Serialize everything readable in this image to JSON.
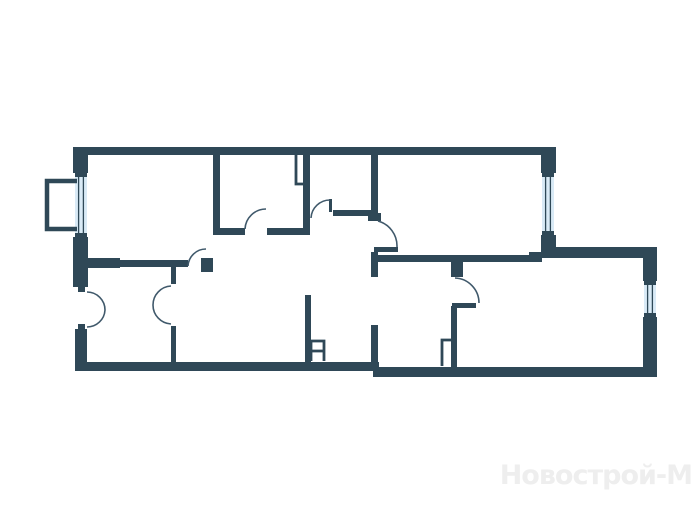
{
  "canvas": {
    "width": 700,
    "height": 525,
    "background": "#ffffff"
  },
  "colors": {
    "wall": "#2f4857",
    "glass": "#d9eaf6",
    "door_arc": "#40596b",
    "watermark": "#eeeeee"
  },
  "watermark": {
    "text": "Новострой-М"
  },
  "floorplan": {
    "rects": [
      {
        "name": "outer-wall-top",
        "x": 73,
        "y": 147,
        "w": 482,
        "h": 8
      },
      {
        "name": "pier-top-left",
        "x": 73,
        "y": 147,
        "w": 15,
        "h": 26
      },
      {
        "name": "pier-left-mid",
        "x": 73,
        "y": 237,
        "w": 15,
        "h": 50
      },
      {
        "name": "door-jamb-notch",
        "x": 78,
        "y": 287,
        "w": 7,
        "h": 5
      },
      {
        "name": "door-jamb-notch",
        "x": 78,
        "y": 324,
        "w": 7,
        "h": 5
      },
      {
        "name": "pier-left-bottom",
        "x": 75,
        "y": 329,
        "w": 12,
        "h": 42
      },
      {
        "name": "outer-wall-bottom-left",
        "x": 75,
        "y": 362,
        "w": 304,
        "h": 9
      },
      {
        "name": "outer-wall-bottom-right",
        "x": 373,
        "y": 367,
        "w": 284,
        "h": 10
      },
      {
        "name": "outer-wall-right-upper",
        "x": 643,
        "y": 247,
        "w": 14,
        "h": 34
      },
      {
        "name": "outer-wall-right-lower",
        "x": 643,
        "y": 317,
        "w": 14,
        "h": 60
      },
      {
        "name": "outer-wall-top-right-sect",
        "x": 555,
        "y": 247,
        "w": 102,
        "h": 11
      },
      {
        "name": "pier-under-tr-window",
        "x": 541,
        "y": 235,
        "w": 15,
        "h": 23
      },
      {
        "name": "wall-step-ledge",
        "x": 529,
        "y": 252,
        "w": 12,
        "h": 6
      },
      {
        "name": "pier-above-tr-window",
        "x": 541,
        "y": 147,
        "w": 15,
        "h": 26
      },
      {
        "name": "wall-room1-right",
        "x": 213,
        "y": 147,
        "w": 7,
        "h": 88
      },
      {
        "name": "wall-kitchen-bottom-left",
        "x": 220,
        "y": 228,
        "w": 25,
        "h": 7
      },
      {
        "name": "wall-kitchen-bottom-right",
        "x": 267,
        "y": 228,
        "w": 41,
        "h": 7
      },
      {
        "name": "wall-shaft-stub",
        "x": 303,
        "y": 155,
        "w": 7,
        "h": 80
      },
      {
        "name": "wall-hall-upper",
        "x": 333,
        "y": 210,
        "w": 40,
        "h": 6
      },
      {
        "name": "door-jamb-tick",
        "x": 329,
        "y": 199,
        "w": 3,
        "h": 13
      },
      {
        "name": "wall-hall-right",
        "x": 371,
        "y": 155,
        "w": 7,
        "h": 60
      },
      {
        "name": "door-jamb",
        "x": 368,
        "y": 213,
        "w": 13,
        "h": 8
      },
      {
        "name": "door-jamb-tick",
        "x": 374,
        "y": 247,
        "w": 24,
        "h": 5
      },
      {
        "name": "wall-hall-stub-lower",
        "x": 371,
        "y": 252,
        "w": 7,
        "h": 25
      },
      {
        "name": "wall-living-bottom",
        "x": 378,
        "y": 255,
        "w": 164,
        "h": 7
      },
      {
        "name": "door-jamb",
        "x": 451,
        "y": 261,
        "w": 12,
        "h": 16
      },
      {
        "name": "door-jamb-tick",
        "x": 452,
        "y": 303,
        "w": 24,
        "h": 5
      },
      {
        "name": "wall-bath-partition",
        "x": 451,
        "y": 306,
        "w": 6,
        "h": 61
      },
      {
        "name": "wall-hall-lower",
        "x": 371,
        "y": 325,
        "w": 7,
        "h": 42
      },
      {
        "name": "wall-corridor-left",
        "x": 305,
        "y": 295,
        "w": 6,
        "h": 67
      },
      {
        "name": "wall-room1-bottom-thick",
        "x": 88,
        "y": 258,
        "w": 32,
        "h": 10
      },
      {
        "name": "wall-room1-bottom",
        "x": 120,
        "y": 260,
        "w": 68,
        "h": 7
      },
      {
        "name": "door-jamb",
        "x": 201,
        "y": 258,
        "w": 12,
        "h": 14
      },
      {
        "name": "wall-room2-divider-top",
        "x": 171,
        "y": 262,
        "w": 5,
        "h": 22
      },
      {
        "name": "wall-room2-divider-bottom",
        "x": 171,
        "y": 326,
        "w": 5,
        "h": 36
      }
    ],
    "windows": [
      {
        "name": "window-left",
        "x": 75,
        "y": 173,
        "w": 12,
        "h": 64
      },
      {
        "name": "window-top-right",
        "x": 542,
        "y": 173,
        "w": 12,
        "h": 62
      },
      {
        "name": "window-bottom-right",
        "x": 644,
        "y": 281,
        "w": 12,
        "h": 36
      }
    ],
    "strokes": [
      {
        "name": "balcony-outline",
        "width": 4.5,
        "d": "M 77 181 H 47 V 229 H 77"
      },
      {
        "name": "vent-shaft-top",
        "width": 2.8,
        "d": "M 296 155 V 184 H 303"
      },
      {
        "name": "vent-shaft-mid",
        "width": 2.8,
        "d": "M 311 361 V 341 H 324 V 361 M 311 351 H 324"
      },
      {
        "name": "vent-shaft-bath",
        "width": 2.8,
        "d": "M 442 366 V 340 H 451"
      }
    ],
    "arcs": [
      {
        "name": "door-swing-balcony-leaf-top",
        "d": "M 87 292 A 18 18 0 0 1 105 310"
      },
      {
        "name": "door-swing-balcony-leaf-bottom",
        "d": "M 87 327 A 18 18 0 0 0 105 310"
      },
      {
        "name": "door-swing-room2-leaf-top",
        "d": "M 171 286 A 19 19 0 0 0 153 305"
      },
      {
        "name": "door-swing-room2-leaf-bottom",
        "d": "M 171 324 A 19 19 0 0 1 153 305"
      },
      {
        "name": "door-swing-room1",
        "d": "M 206 249 A 18 18 0 0 0 188 266"
      },
      {
        "name": "door-swing-kitchen",
        "d": "M 245 229 A 21 21 0 0 1 266 209"
      },
      {
        "name": "door-swing-hall-upper",
        "d": "M 311 218 A 19 19 0 0 1 330 200"
      },
      {
        "name": "door-swing-living",
        "d": "M 378 221 A 26 26 0 0 1 397 247"
      },
      {
        "name": "door-swing-bathroom",
        "d": "M 455 278 A 25 25 0 0 1 479 303"
      }
    ]
  }
}
